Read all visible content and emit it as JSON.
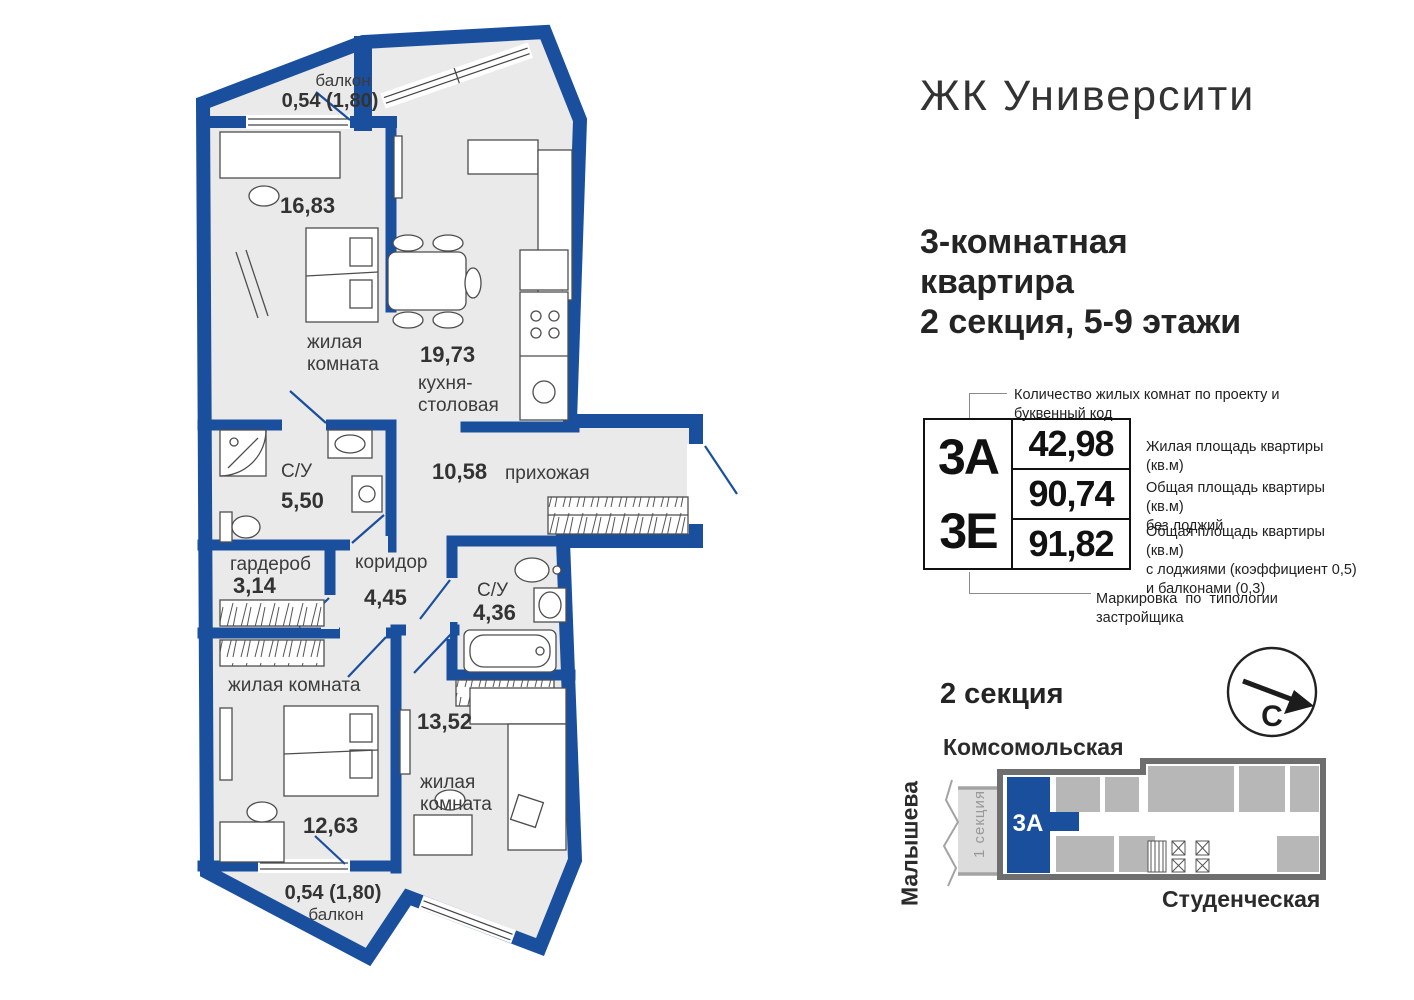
{
  "colors": {
    "wall_blue": "#1a4f9e",
    "floor_gray": "#eaeaea",
    "map_unit_gray": "#b7b7b7",
    "map_outline_gray": "#6e6e6e",
    "text_dark": "#262626"
  },
  "header": {
    "title": "ЖК Университи"
  },
  "apartment": {
    "line1": "3-комнатная",
    "line2": "квартира",
    "line3": "2 секция, 5-9 этажи"
  },
  "spec": {
    "code_top": "3А",
    "code_bottom": "3Е",
    "values": [
      "42,98",
      "90,74",
      "91,82"
    ],
    "notes": {
      "top": "Количество жилых комнат по проекту и буквенный код",
      "bottom": "Маркировка по типологии застройщика",
      "r1_l1": "Жилая площадь квартиры (кв.м)",
      "r2_l1": "Общая площадь квартиры (кв.м)",
      "r2_l2": "без лоджий",
      "r3_l1": "Общая площадь квартиры (кв.м)",
      "r3_l2": "с лоджиями (коэффициент 0,5)",
      "r3_l3": "и балконами (0,3)"
    }
  },
  "plan": {
    "balcony_top": {
      "name": "балкон",
      "area": "0,54 (1,80)"
    },
    "room1": {
      "area": "16,83",
      "name_l1": "жилая",
      "name_l2": "комната"
    },
    "kitchen": {
      "area": "19,73",
      "name_l1": "кухня-",
      "name_l2": "столовая"
    },
    "bath1": {
      "name": "С/У",
      "area": "5,50"
    },
    "hall": {
      "area": "10,58",
      "name": "прихожая"
    },
    "wardrobe": {
      "name": "гардероб",
      "area": "3,14"
    },
    "corridor": {
      "name": "коридор",
      "area": "4,45"
    },
    "bath2": {
      "name": "С/У",
      "area": "4,36"
    },
    "room2": {
      "name": "жилая комната",
      "area": "12,63"
    },
    "room3": {
      "area": "13,52",
      "name_l1": "жилая",
      "name_l2": "комната"
    },
    "balcony_bottom": {
      "area": "0,54 (1,80)",
      "name": "балкон"
    }
  },
  "map": {
    "heading": "2 секция",
    "street_top": "Комсомольская",
    "street_left": "Малышева",
    "street_bottom": "Студенческая",
    "section1": "1 секция",
    "unit": "3А",
    "compass": "С"
  }
}
